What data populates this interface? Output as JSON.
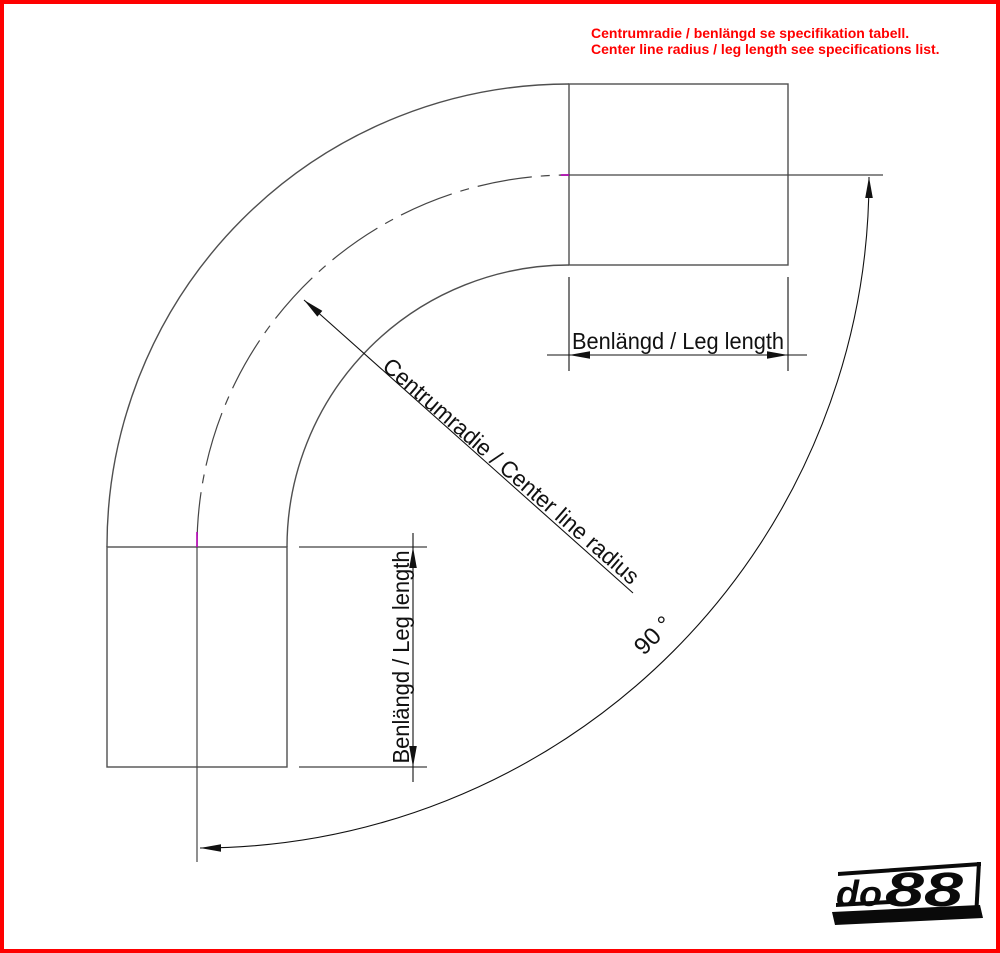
{
  "page": {
    "width": 1000,
    "height": 953
  },
  "notice": {
    "line1": "Centrumradie / benlängd se specifikation tabell.",
    "line2": "Center line radius / leg length see specifications list."
  },
  "labels": {
    "top_leg": "Benlängd / Leg length",
    "left_leg": "Benlängd / Leg length",
    "radius": "Centrumradie / Center line radius",
    "angle": "90 °"
  },
  "logo": {
    "do": "do",
    "eights": "88"
  },
  "colors": {
    "border": "#fe0000",
    "notice_text": "#ff0000",
    "geometry_line": "#4f4f4f",
    "centerline": "#454545",
    "centerline_tick": "#b400b4",
    "dimension_line": "#111111",
    "logo": "#0a0a0a"
  },
  "drawing_meta": {
    "bend_angle_deg": 90,
    "parts": [
      "outer-wall-arc",
      "inner-wall-arc",
      "center-line-arc",
      "top-leg",
      "left-leg"
    ]
  }
}
